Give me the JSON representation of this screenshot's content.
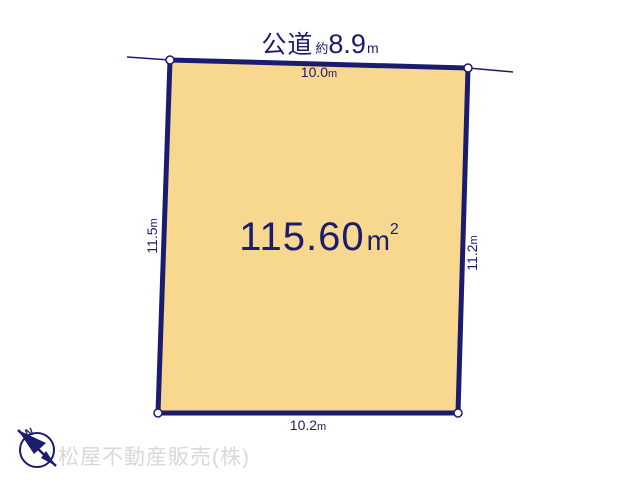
{
  "colors": {
    "navy": "#1b1b70",
    "plot_fill": "#f8d78f",
    "company_gray": "#d8d8d8",
    "background": "#ffffff"
  },
  "road": {
    "name": "公道",
    "approx_prefix": "約",
    "value": "8.9",
    "unit": "m"
  },
  "plot": {
    "area": {
      "value": "115.60",
      "unit": "m",
      "sup": "2"
    },
    "dimensions": {
      "top": {
        "value": "10.0",
        "unit": "m"
      },
      "bottom": {
        "value": "10.2",
        "unit": "m"
      },
      "left": {
        "value": "11.5",
        "unit": "m"
      },
      "right": {
        "value": "11.2",
        "unit": "m"
      }
    }
  },
  "compass": {
    "label": "N"
  },
  "footer": {
    "company": "松屋不動産販売(株)"
  }
}
